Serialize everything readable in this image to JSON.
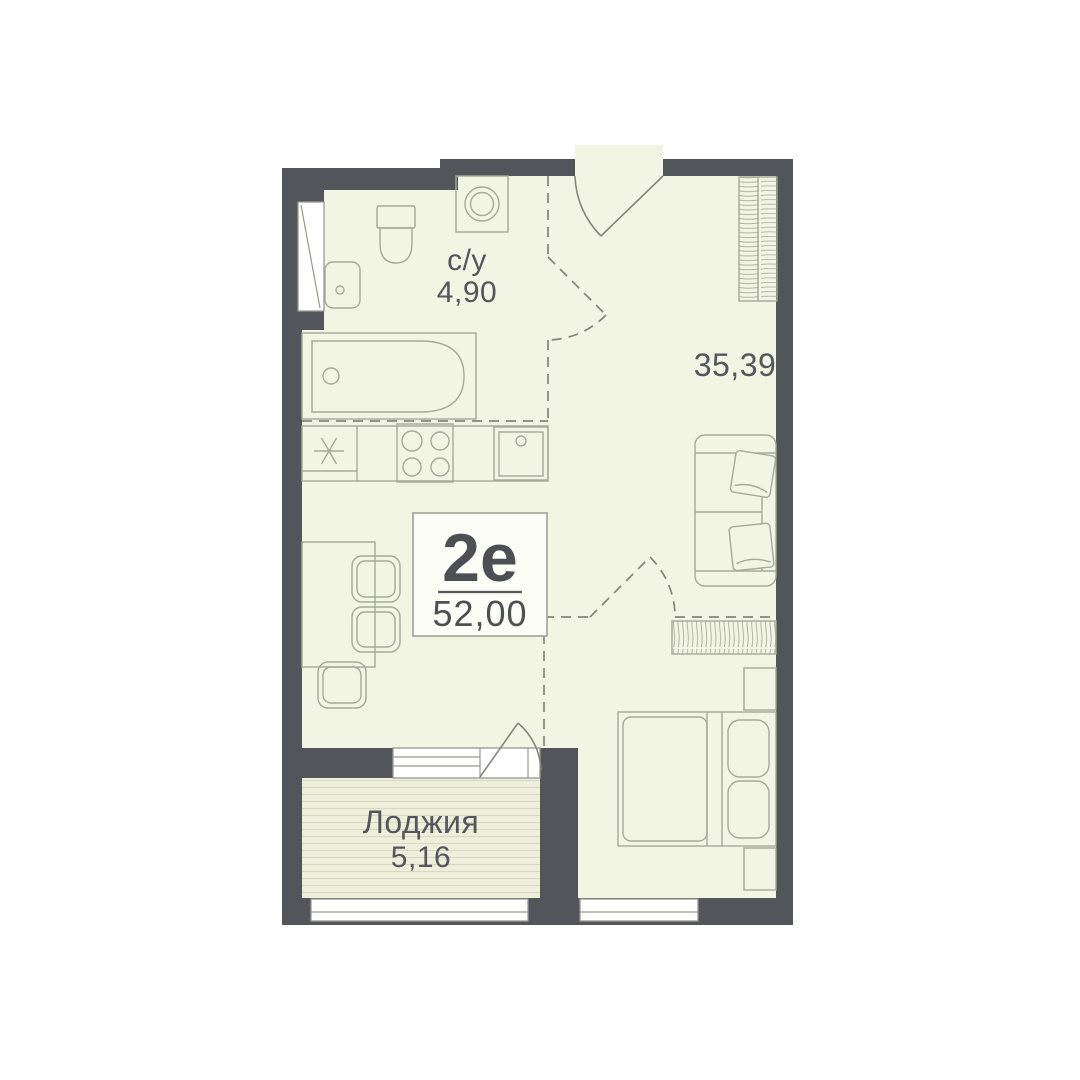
{
  "plan": {
    "title": "apartment-floor-plan",
    "unit": {
      "type_label": "2е",
      "total_area": "52,00"
    },
    "rooms": [
      {
        "id": "bathroom",
        "label": "с/у",
        "area": "4,90"
      },
      {
        "id": "living-room",
        "label": "",
        "area": "35,39"
      },
      {
        "id": "loggia",
        "label": "Лоджия",
        "area": "5,16"
      }
    ],
    "fixtures": [
      "entrance-door",
      "wardrobe",
      "sofa",
      "sofa-pillows",
      "dresser",
      "double-bed",
      "bed-pillows",
      "nightstand",
      "dining-table",
      "chair",
      "fridge",
      "stove",
      "kitchen-sink",
      "bathtub",
      "toilet",
      "wash-basin",
      "washing-machine",
      "window",
      "balcony-door"
    ],
    "colors": {
      "background": "#ffffff",
      "wall": "#54555a",
      "floor": "#f2f4e4",
      "loggia_floor": "#edefdc",
      "furniture_stroke": "#a5a998",
      "dashed_zone_line": "#83857a",
      "text": "#55565a",
      "window_fill": "#ffffff"
    }
  }
}
